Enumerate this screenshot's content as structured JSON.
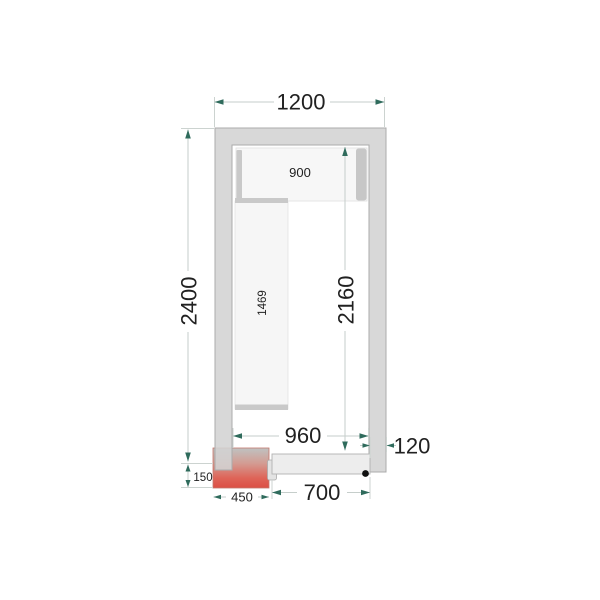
{
  "diagram": {
    "kind": "cold-room-floor-plan",
    "dims": {
      "outer_width": "1200",
      "outer_depth": "2400",
      "inner_width": "960",
      "inner_depth": "2160",
      "wall_thickness": "120",
      "door_width": "700",
      "unit_width": "450",
      "unit_protrusion": "150",
      "top_shelf_length": "900",
      "side_shelf_length": "1469"
    },
    "colors": {
      "wall_fill": "#d3d3d3",
      "wall_stroke": "#ababab",
      "shelf_fill": "#f6f6f6",
      "shelf_rail": "#c9c9c9",
      "door_fill": "#ededed",
      "unit_red": "#dc4f44",
      "unit_gray": "#bfc2c1",
      "dim_line": "#c6cecb",
      "dim_arrow": "#2f6b5c",
      "text": "#212121",
      "hinge_dot": "#111111"
    }
  }
}
